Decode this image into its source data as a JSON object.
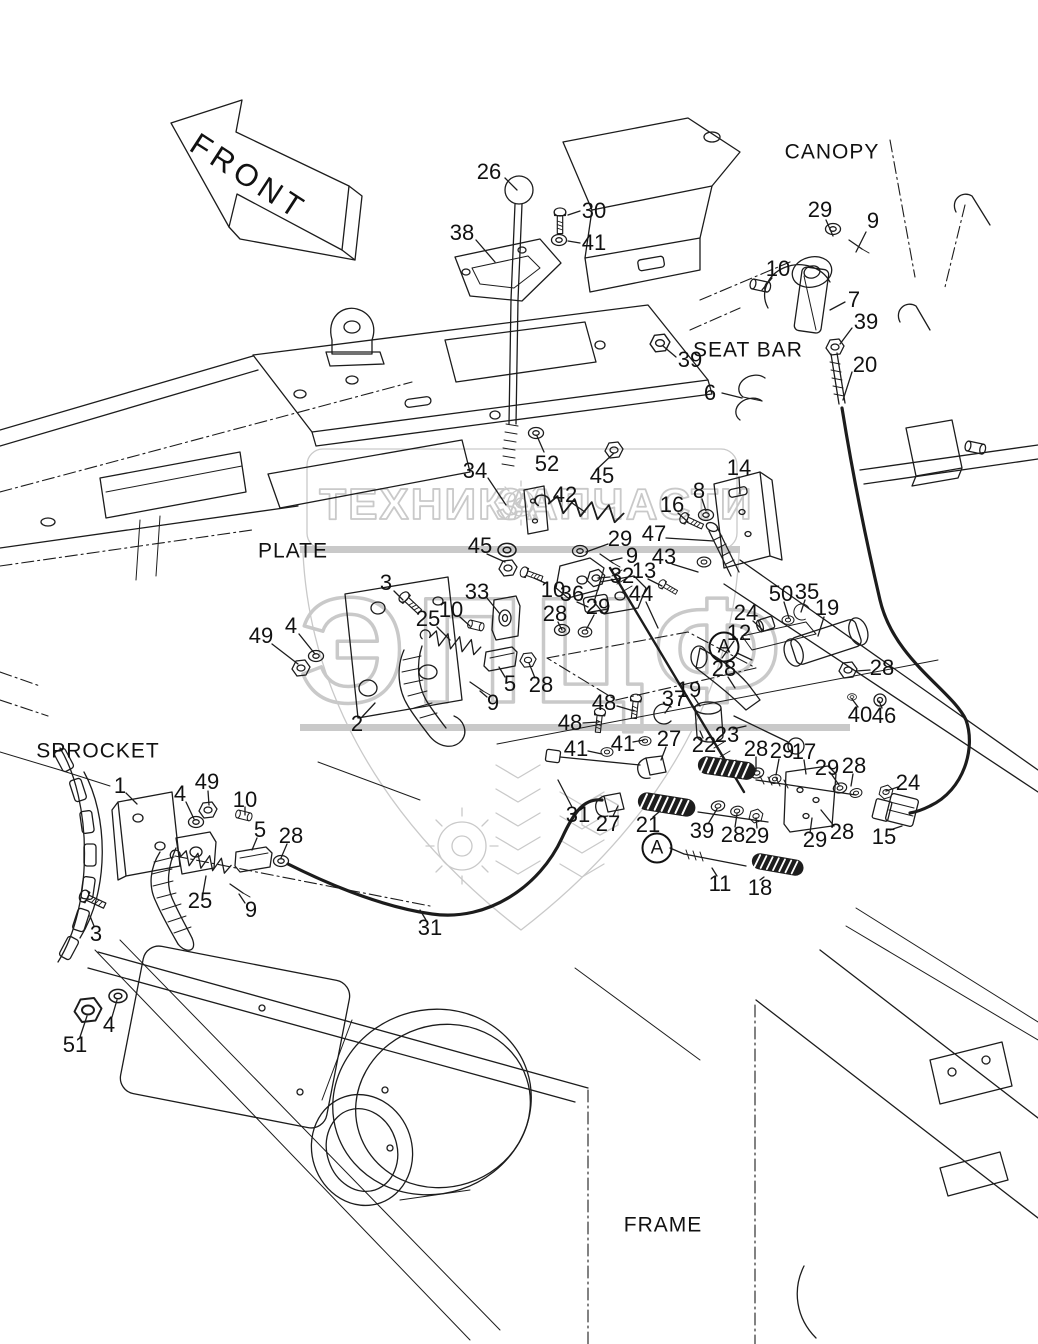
{
  "page": {
    "background": "#ffffff",
    "line_color": "#1c1c1c",
    "watermark_color": "#c9c9c9"
  },
  "front_arrow": {
    "label": "FRONT"
  },
  "watermark": {
    "left": "ТЕХНИКА",
    "right": "ЗАПЧАСТИ",
    "monogram": "ЭПЦФ",
    "gear_icon": "gear-icon"
  },
  "area_labels": [
    {
      "text": "CANOPY",
      "x": 832,
      "y": 152
    },
    {
      "text": "SEAT BAR",
      "x": 748,
      "y": 350
    },
    {
      "text": "PLATE",
      "x": 293,
      "y": 551
    },
    {
      "text": "SPROCKET",
      "x": 98,
      "y": 751
    },
    {
      "text": "FRAME",
      "x": 663,
      "y": 1225
    }
  ],
  "detail_markers": [
    {
      "n": "A",
      "x": 724,
      "y": 647
    },
    {
      "n": "A",
      "x": 657,
      "y": 848
    }
  ],
  "part_labels": [
    {
      "n": "26",
      "x": 489,
      "y": 172
    },
    {
      "n": "30",
      "x": 594,
      "y": 211
    },
    {
      "n": "38",
      "x": 462,
      "y": 233
    },
    {
      "n": "41",
      "x": 594,
      "y": 243
    },
    {
      "n": "29",
      "x": 820,
      "y": 210
    },
    {
      "n": "9",
      "x": 873,
      "y": 221
    },
    {
      "n": "10",
      "x": 778,
      "y": 269
    },
    {
      "n": "7",
      "x": 854,
      "y": 300
    },
    {
      "n": "39",
      "x": 866,
      "y": 322
    },
    {
      "n": "20",
      "x": 865,
      "y": 365
    },
    {
      "n": "39",
      "x": 690,
      "y": 360
    },
    {
      "n": "6",
      "x": 710,
      "y": 393
    },
    {
      "n": "34",
      "x": 475,
      "y": 471
    },
    {
      "n": "52",
      "x": 547,
      "y": 464
    },
    {
      "n": "45",
      "x": 602,
      "y": 476
    },
    {
      "n": "42",
      "x": 565,
      "y": 495
    },
    {
      "n": "14",
      "x": 739,
      "y": 468
    },
    {
      "n": "8",
      "x": 699,
      "y": 491
    },
    {
      "n": "16",
      "x": 672,
      "y": 505
    },
    {
      "n": "47",
      "x": 654,
      "y": 534
    },
    {
      "n": "29",
      "x": 620,
      "y": 539
    },
    {
      "n": "9",
      "x": 632,
      "y": 556
    },
    {
      "n": "43",
      "x": 664,
      "y": 557
    },
    {
      "n": "13",
      "x": 644,
      "y": 571
    },
    {
      "n": "32",
      "x": 622,
      "y": 576
    },
    {
      "n": "10",
      "x": 553,
      "y": 590
    },
    {
      "n": "36",
      "x": 572,
      "y": 594
    },
    {
      "n": "44",
      "x": 641,
      "y": 594
    },
    {
      "n": "45",
      "x": 480,
      "y": 546
    },
    {
      "n": "33",
      "x": 477,
      "y": 592
    },
    {
      "n": "10",
      "x": 451,
      "y": 610
    },
    {
      "n": "25",
      "x": 428,
      "y": 619
    },
    {
      "n": "3",
      "x": 386,
      "y": 583
    },
    {
      "n": "4",
      "x": 291,
      "y": 626
    },
    {
      "n": "49",
      "x": 261,
      "y": 636
    },
    {
      "n": "28",
      "x": 555,
      "y": 614
    },
    {
      "n": "29",
      "x": 598,
      "y": 607
    },
    {
      "n": "24",
      "x": 746,
      "y": 613
    },
    {
      "n": "12",
      "x": 739,
      "y": 633
    },
    {
      "n": "50",
      "x": 781,
      "y": 594
    },
    {
      "n": "35",
      "x": 807,
      "y": 592
    },
    {
      "n": "19",
      "x": 827,
      "y": 608
    },
    {
      "n": "28",
      "x": 882,
      "y": 668
    },
    {
      "n": "40",
      "x": 860,
      "y": 715
    },
    {
      "n": "46",
      "x": 884,
      "y": 716
    },
    {
      "n": "28",
      "x": 724,
      "y": 669
    },
    {
      "n": "19",
      "x": 689,
      "y": 690
    },
    {
      "n": "37",
      "x": 674,
      "y": 699
    },
    {
      "n": "5",
      "x": 510,
      "y": 684
    },
    {
      "n": "28",
      "x": 541,
      "y": 685
    },
    {
      "n": "9",
      "x": 493,
      "y": 703
    },
    {
      "n": "2",
      "x": 357,
      "y": 724
    },
    {
      "n": "22",
      "x": 704,
      "y": 745
    },
    {
      "n": "23",
      "x": 727,
      "y": 735
    },
    {
      "n": "48",
      "x": 604,
      "y": 703
    },
    {
      "n": "48",
      "x": 570,
      "y": 723
    },
    {
      "n": "41",
      "x": 623,
      "y": 744
    },
    {
      "n": "41",
      "x": 576,
      "y": 749
    },
    {
      "n": "27",
      "x": 669,
      "y": 739
    },
    {
      "n": "28",
      "x": 756,
      "y": 749
    },
    {
      "n": "29",
      "x": 782,
      "y": 751
    },
    {
      "n": "17",
      "x": 804,
      "y": 752
    },
    {
      "n": "29",
      "x": 827,
      "y": 768
    },
    {
      "n": "28",
      "x": 854,
      "y": 766
    },
    {
      "n": "24",
      "x": 908,
      "y": 783
    },
    {
      "n": "15",
      "x": 884,
      "y": 837
    },
    {
      "n": "28",
      "x": 842,
      "y": 832
    },
    {
      "n": "29",
      "x": 815,
      "y": 840
    },
    {
      "n": "31",
      "x": 578,
      "y": 815
    },
    {
      "n": "27",
      "x": 608,
      "y": 824
    },
    {
      "n": "21",
      "x": 648,
      "y": 825
    },
    {
      "n": "39",
      "x": 702,
      "y": 831
    },
    {
      "n": "28",
      "x": 733,
      "y": 835
    },
    {
      "n": "29",
      "x": 757,
      "y": 836
    },
    {
      "n": "11",
      "x": 720,
      "y": 884
    },
    {
      "n": "18",
      "x": 760,
      "y": 888
    },
    {
      "n": "1",
      "x": 120,
      "y": 786
    },
    {
      "n": "49",
      "x": 207,
      "y": 782
    },
    {
      "n": "4",
      "x": 180,
      "y": 794
    },
    {
      "n": "10",
      "x": 245,
      "y": 800
    },
    {
      "n": "5",
      "x": 260,
      "y": 830
    },
    {
      "n": "28",
      "x": 291,
      "y": 836
    },
    {
      "n": "25",
      "x": 200,
      "y": 901
    },
    {
      "n": "9",
      "x": 251,
      "y": 910
    },
    {
      "n": "3",
      "x": 96,
      "y": 934
    },
    {
      "n": "31",
      "x": 430,
      "y": 928
    },
    {
      "n": "4",
      "x": 109,
      "y": 1025
    },
    {
      "n": "51",
      "x": 75,
      "y": 1045
    }
  ]
}
